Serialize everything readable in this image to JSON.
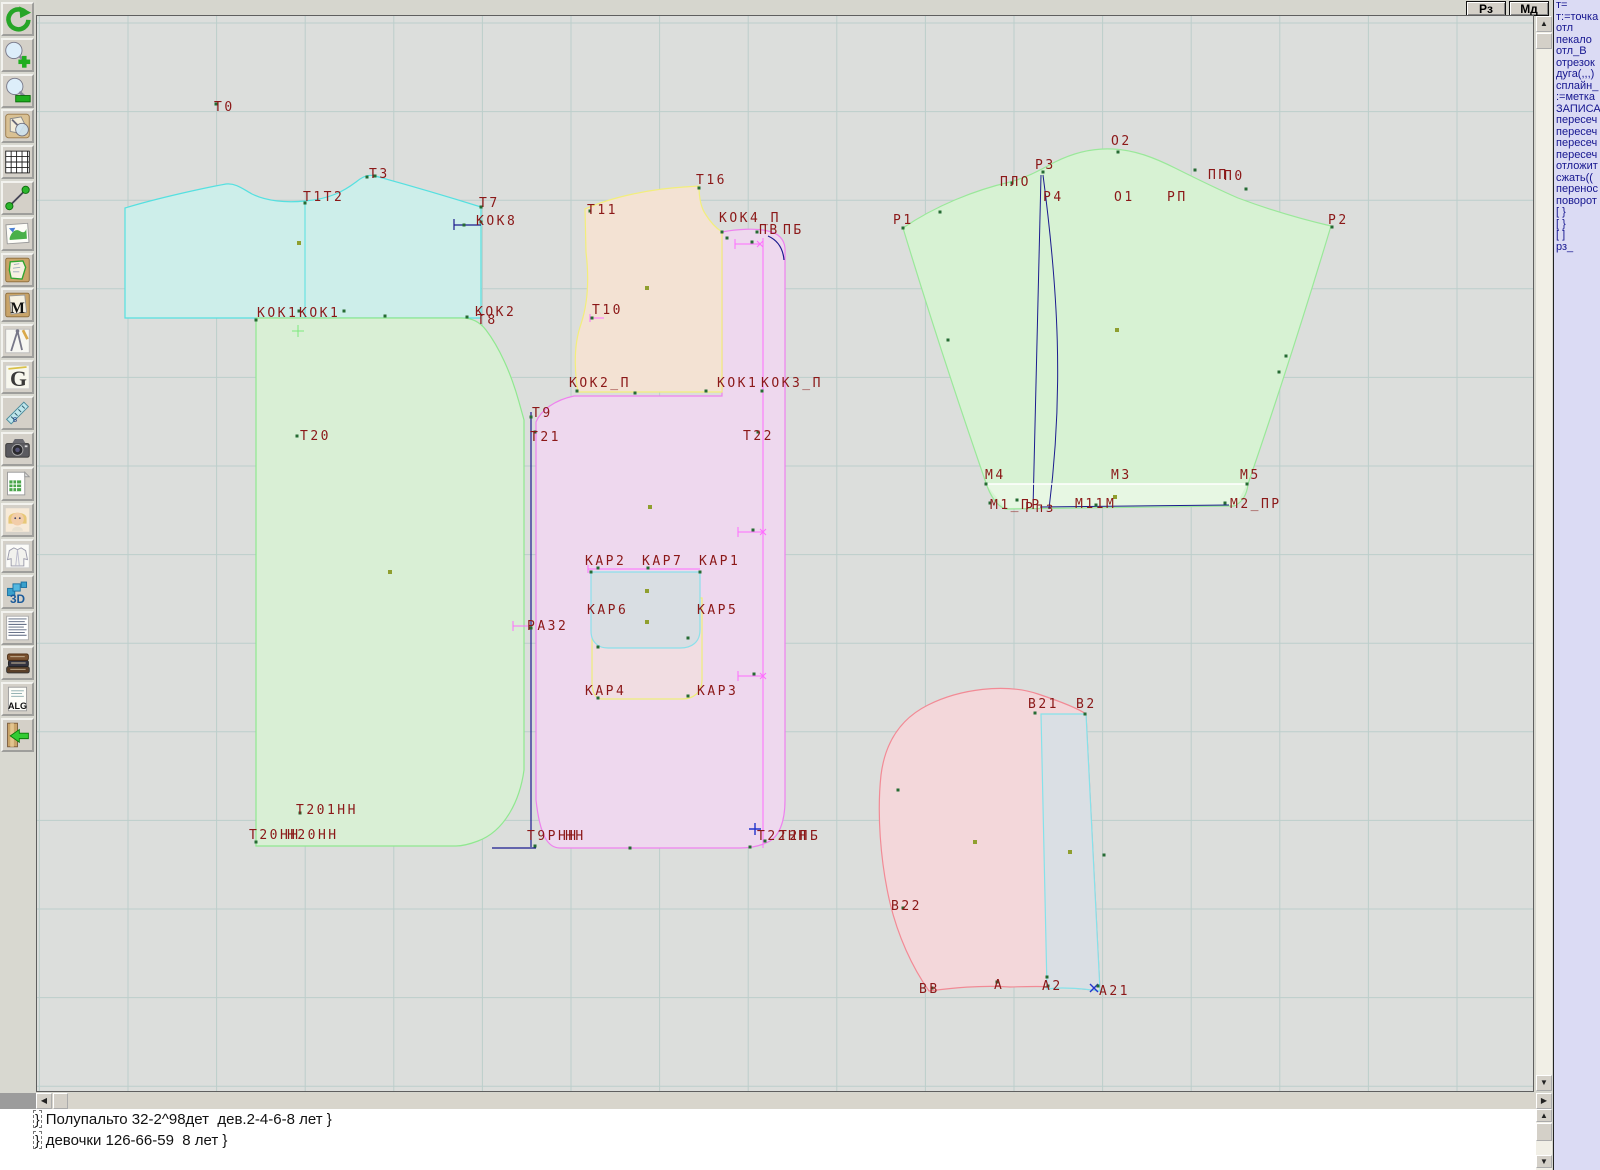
{
  "topbar": {
    "buttons": [
      {
        "label": "Рз"
      },
      {
        "label": "Мд"
      }
    ]
  },
  "icons": {
    "scroll_up": "▲",
    "scroll_down": "▼",
    "scroll_left": "◀",
    "scroll_right": "▶"
  },
  "toolbar": {
    "items": [
      {
        "name": "undo",
        "icon": "undo-icon"
      },
      {
        "name": "zoom-in",
        "icon": "zoom-in-icon"
      },
      {
        "name": "zoom-out",
        "icon": "zoom-out-icon"
      },
      {
        "name": "preview",
        "icon": "preview-icon"
      },
      {
        "name": "grid",
        "icon": "grid-icon"
      },
      {
        "name": "measure",
        "icon": "measure-icon"
      },
      {
        "name": "image",
        "icon": "image-icon"
      },
      {
        "name": "pattern-piece",
        "icon": "pattern-piece-icon"
      },
      {
        "name": "pattern-m",
        "icon": "pattern-m-icon"
      },
      {
        "name": "drafting",
        "icon": "drafting-icon"
      },
      {
        "name": "g-tool",
        "icon": "g-tool-icon"
      },
      {
        "name": "ruler",
        "icon": "ruler-icon"
      },
      {
        "name": "camera",
        "icon": "camera-icon"
      },
      {
        "name": "spreadsheet",
        "icon": "spreadsheet-icon"
      },
      {
        "name": "portrait",
        "icon": "portrait-icon"
      },
      {
        "name": "garment",
        "icon": "garment-icon"
      },
      {
        "name": "view-3d",
        "icon": "3d-icon"
      },
      {
        "name": "text-list",
        "icon": "text-list-icon"
      },
      {
        "name": "library",
        "icon": "library-icon"
      },
      {
        "name": "alg",
        "icon": "alg-icon"
      },
      {
        "name": "exit",
        "icon": "exit-icon"
      }
    ]
  },
  "right_panel": {
    "lines": [
      "т=",
      "т:=точка",
      "отл",
      "пекало",
      "отл_В",
      "отрезок",
      "дуга(,,,)",
      "сплайн_",
      ":=метка",
      "ЗАПИСА",
      "пересеч",
      "пересеч",
      "пересеч",
      "пересеч",
      "отложит",
      "сжать((",
      "перенос",
      "поворот",
      "[ }",
      "[ }",
      "[ ]",
      "рз_"
    ]
  },
  "console": {
    "cursor": "}",
    "lines": [
      "Полупальто 32-2^98дет  дев.2-4-6-8 лет }",
      "девочки 126-66-59  8 лет }"
    ]
  },
  "canvas": {
    "background": "#dcdedc",
    "grid": {
      "step": 88.6,
      "x0": 39.4,
      "y0": 23,
      "color": "#bccecb"
    },
    "label_color": "#8b1818",
    "point_color": "#256b33",
    "olive_color": "#8f9f2f",
    "pieces": [
      {
        "name": "piece-back-yoke",
        "fill": "#cdeeea",
        "stroke": "#55e0e0",
        "path": "M125,318 L125,208 C158,198 204,188 226,184 C236,183 243,189 252,194 C266,201 286,203 305,201 C330,199 344,191 356,182 C363,176 369,174 375,176 C408,185 452,198 481,207 L481,318 Z"
      },
      {
        "name": "piece-back",
        "fill": "#d9efd5",
        "stroke": "#90e890",
        "path": "M256,318 L462,318 C472,318 480,322 486,330 C499,347 511,373 519,402 L524,420 L524,770 C520,800 505,831 478,841 C470,844 462,846 456,846 L256,846 Z"
      },
      {
        "name": "piece-front",
        "fill": "#eed8ee",
        "stroke": "#ee82ee",
        "path": "M536,422 C541,410 555,400 574,396 L722,396 L722,232 C737,229 757,228 768,231 C777,233 784,238 785,248 L785,800 C785,822 779,837 768,842 C760,846 750,848 740,848 L560,848 C548,848 540,836 536,800 Z"
      },
      {
        "name": "piece-front-yoke",
        "fill": "#f3e2d3",
        "stroke": "#f2ee7c",
        "path": "M578,392 C574,368 574,344 581,324 C588,303 589,277 586,252 L585,209 C612,197 650,189 684,187 L699,186 C699,198 701,208 706,215 C711,223 716,228 722,232 L722,392 Z"
      },
      {
        "name": "piece-sleeve",
        "fill": "#d7f2d3",
        "stroke": "#9ae89a",
        "path": "M903,228 C935,206 975,190 1010,182 C1028,177 1040,170 1055,162 C1075,152 1095,148 1113,149 C1135,150 1155,158 1175,168 C1195,178 1215,188 1238,198 C1270,210 1305,220 1331,226 Q1290,362 1248,484 C1247,494 1243,502 1234,506 L1005,509 C996,505 990,495 986,483 Q940,350 903,228 Z"
      },
      {
        "name": "piece-sleeve-hem",
        "fill": "#e7f7e3",
        "stroke": "none",
        "path": "M986,484 L1247,484 L1236,505 L1005,508 Z"
      },
      {
        "name": "piece-hood",
        "fill": "#f3d7da",
        "stroke": "#f28a95",
        "path": "M929,991 C912,967 898,936 890,903 C880,860 877,812 881,775 C885,743 900,719 928,705 C960,689 1005,683 1038,694 C1056,700 1076,707 1086,714 L1100,991 C1062,986 1040,986 1010,987 C980,985 952,988 929,991 Z"
      },
      {
        "name": "piece-hood-strip",
        "fill": "#dadfe4",
        "stroke": "#85e2ea",
        "path": "M1041,714 L1086,714 L1100,991 C1078,988 1060,987 1047,989 Z"
      },
      {
        "name": "piece-pocket",
        "fill": "#f1dde2",
        "stroke": "#eeee7a",
        "path": "M592,597 L702,598 L702,680 C702,692 694,699 682,699 L602,699 C595,699 592,692 592,682 Z"
      },
      {
        "name": "piece-pocket-flap",
        "fill": "#d9dee3",
        "stroke": "#8ce0ea",
        "path": "M591,572 L700,572 L700,630 C700,642 692,648 680,648 L608,648 C597,648 591,641 591,631 Z"
      }
    ],
    "lines": [
      {
        "stroke": "#1b1b8e",
        "w": 1.2,
        "d": "M531,412 L531,847"
      },
      {
        "stroke": "#1b1b8e",
        "w": 1.2,
        "d": "M492,848 L536,848"
      },
      {
        "stroke": "#1b1b8e",
        "w": 1,
        "d": "M1041,175 L1033,509"
      },
      {
        "stroke": "#1b1b8e",
        "w": 1,
        "d": "M1043,175 C1058,290 1064,390 1049,509"
      },
      {
        "stroke": "#1b1b8e",
        "w": 1,
        "d": "M1040,507 L1229,505"
      },
      {
        "stroke": "#1b1b8e",
        "w": 1.2,
        "d": "M768,236 C777,240 783,248 784,260"
      },
      {
        "stroke": "#1b1b8e",
        "w": 1.2,
        "d": "M454,219 L454,230 M454,225 L481,225"
      },
      {
        "stroke": "#ffffff",
        "w": 1.5,
        "d": "M986,484 L1247,484"
      },
      {
        "stroke": "#55e0e0",
        "w": 1,
        "d": "M305,202 L305,318"
      },
      {
        "stroke": "#ff6dff",
        "w": 1,
        "d": "M763,238 L763,848"
      },
      {
        "stroke": "#ff6dff",
        "w": 1,
        "d": "M738,532 L763,532 M738,527 L738,537 M760,529 L766,535 M766,529 L760,535"
      },
      {
        "stroke": "#ff6dff",
        "w": 1,
        "d": "M738,676 L763,676 M738,671 L738,681 M760,673 L766,679 M766,673 L760,679"
      },
      {
        "stroke": "#ff6dff",
        "w": 1,
        "d": "M735,244 L760,244 M735,239 L735,249 M757,241 L763,247 M763,241 L757,247"
      },
      {
        "stroke": "#ff6dff",
        "w": 1,
        "d": "M590,318 L604,318 M590,314 L590,322"
      },
      {
        "stroke": "#ff6dff",
        "w": 1,
        "d": "M513,626 L528,626 M513,621 L513,631"
      },
      {
        "stroke": "#ff6dff",
        "w": 1,
        "d": "M588,569 L700,569 M588,565 L588,573"
      },
      {
        "stroke": "#7de87d",
        "w": 1,
        "d": "M298,325 L298,337 M292,331 L304,331"
      },
      {
        "stroke": "#2233cc",
        "w": 1.4,
        "d": "M749,829 L761,829 M755,823 L755,835"
      },
      {
        "stroke": "#2233cc",
        "w": 1.4,
        "d": "M1090,984 L1098,992 M1098,984 L1090,992"
      }
    ],
    "points": [
      [
        216,
        104
      ],
      [
        305,
        203
      ],
      [
        367,
        177
      ],
      [
        375,
        176
      ],
      [
        481,
        207
      ],
      [
        481,
        222
      ],
      [
        464,
        225
      ],
      [
        299,
        311
      ],
      [
        344,
        311
      ],
      [
        385,
        316
      ],
      [
        467,
        317
      ],
      [
        256,
        320
      ],
      [
        297,
        436
      ],
      [
        590,
        211
      ],
      [
        699,
        188
      ],
      [
        592,
        318
      ],
      [
        577,
        391
      ],
      [
        635,
        393
      ],
      [
        722,
        232
      ],
      [
        727,
        238
      ],
      [
        757,
        232
      ],
      [
        531,
        417
      ],
      [
        535,
        432
      ],
      [
        758,
        432
      ],
      [
        531,
        628
      ],
      [
        535,
        846
      ],
      [
        630,
        848
      ],
      [
        750,
        847
      ],
      [
        765,
        841
      ],
      [
        706,
        391
      ],
      [
        762,
        391
      ],
      [
        598,
        568
      ],
      [
        648,
        568
      ],
      [
        591,
        572
      ],
      [
        700,
        572
      ],
      [
        598,
        647
      ],
      [
        688,
        638
      ],
      [
        598,
        698
      ],
      [
        688,
        696
      ],
      [
        752,
        242
      ],
      [
        753,
        530
      ],
      [
        754,
        674
      ],
      [
        940,
        212
      ],
      [
        1012,
        183
      ],
      [
        1043,
        172
      ],
      [
        1118,
        152
      ],
      [
        1195,
        170
      ],
      [
        1246,
        189
      ],
      [
        1332,
        227
      ],
      [
        903,
        228
      ],
      [
        948,
        340
      ],
      [
        1286,
        356
      ],
      [
        1279,
        372
      ],
      [
        990,
        503
      ],
      [
        1017,
        500
      ],
      [
        1096,
        505
      ],
      [
        1225,
        503
      ],
      [
        986,
        484
      ],
      [
        1247,
        484
      ],
      [
        1035,
        713
      ],
      [
        1085,
        714
      ],
      [
        898,
        790
      ],
      [
        903,
        908
      ],
      [
        932,
        988
      ],
      [
        997,
        982
      ],
      [
        1048,
        986
      ],
      [
        1098,
        986
      ],
      [
        1104,
        855
      ],
      [
        1047,
        977
      ],
      [
        300,
        813
      ],
      [
        256,
        842
      ]
    ],
    "olive_points": [
      [
        299,
        243
      ],
      [
        390,
        572
      ],
      [
        647,
        288
      ],
      [
        650,
        507
      ],
      [
        647,
        591
      ],
      [
        647,
        622
      ],
      [
        1117,
        330
      ],
      [
        1115,
        497
      ],
      [
        975,
        842
      ],
      [
        1070,
        852
      ]
    ],
    "labels": [
      [
        214,
        101,
        "Т0"
      ],
      [
        303,
        191,
        "Т1Т2"
      ],
      [
        369,
        168,
        "Т3"
      ],
      [
        479,
        197,
        "Т7"
      ],
      [
        476,
        215,
        "КОК8"
      ],
      [
        257,
        307,
        "КОК1"
      ],
      [
        299,
        307,
        "КОК1"
      ],
      [
        475,
        306,
        "КОК2"
      ],
      [
        477,
        314,
        "Т8"
      ],
      [
        587,
        204,
        "Т11"
      ],
      [
        696,
        174,
        "Т16"
      ],
      [
        719,
        212,
        "КОК4_П"
      ],
      [
        759,
        224,
        "ПВ"
      ],
      [
        783,
        224,
        "ПБ"
      ],
      [
        592,
        304,
        "Т10"
      ],
      [
        569,
        377,
        "КОК2_П"
      ],
      [
        717,
        377,
        "КОК1"
      ],
      [
        761,
        377,
        "КОК3_П"
      ],
      [
        532,
        407,
        "Т9"
      ],
      [
        530,
        431,
        "Т21"
      ],
      [
        743,
        430,
        "Т22"
      ],
      [
        300,
        430,
        "Т20"
      ],
      [
        585,
        555,
        "КАР2"
      ],
      [
        642,
        555,
        "КАР7"
      ],
      [
        699,
        555,
        "КАР1"
      ],
      [
        587,
        604,
        "КАР6"
      ],
      [
        697,
        604,
        "КАР5"
      ],
      [
        527,
        620,
        "РАЗ2"
      ],
      [
        585,
        685,
        "КАР4"
      ],
      [
        697,
        685,
        "КАР3"
      ],
      [
        296,
        804,
        "Т201НН"
      ],
      [
        249,
        829,
        "Т20НН"
      ],
      [
        287,
        829,
        "Н20НН"
      ],
      [
        527,
        830,
        "Т9РНН"
      ],
      [
        565,
        830,
        "НН"
      ],
      [
        757,
        830,
        "Т22НН"
      ],
      [
        779,
        830,
        "Т2ПБ"
      ],
      [
        1111,
        135,
        "О2"
      ],
      [
        1035,
        159,
        "Р3"
      ],
      [
        1000,
        176,
        "ПЛО"
      ],
      [
        1043,
        191,
        "Р4"
      ],
      [
        1114,
        191,
        "О1"
      ],
      [
        1167,
        191,
        "РП"
      ],
      [
        1208,
        169,
        "ПП"
      ],
      [
        1224,
        170,
        "П0"
      ],
      [
        893,
        214,
        "Р1"
      ],
      [
        1328,
        214,
        "Р2"
      ],
      [
        985,
        469,
        "М4"
      ],
      [
        1111,
        469,
        "М3"
      ],
      [
        1240,
        469,
        "М5"
      ],
      [
        990,
        499,
        "М1_ПР"
      ],
      [
        1025,
        502,
        "Рпз"
      ],
      [
        1075,
        498,
        "М11М"
      ],
      [
        1230,
        498,
        "М2_ПР"
      ],
      [
        1028,
        698,
        "В21"
      ],
      [
        1076,
        698,
        "В2"
      ],
      [
        891,
        900,
        "В22"
      ],
      [
        919,
        983,
        "ВВ"
      ],
      [
        994,
        979,
        "А"
      ],
      [
        1042,
        980,
        "А2"
      ],
      [
        1099,
        985,
        "А21"
      ]
    ]
  }
}
